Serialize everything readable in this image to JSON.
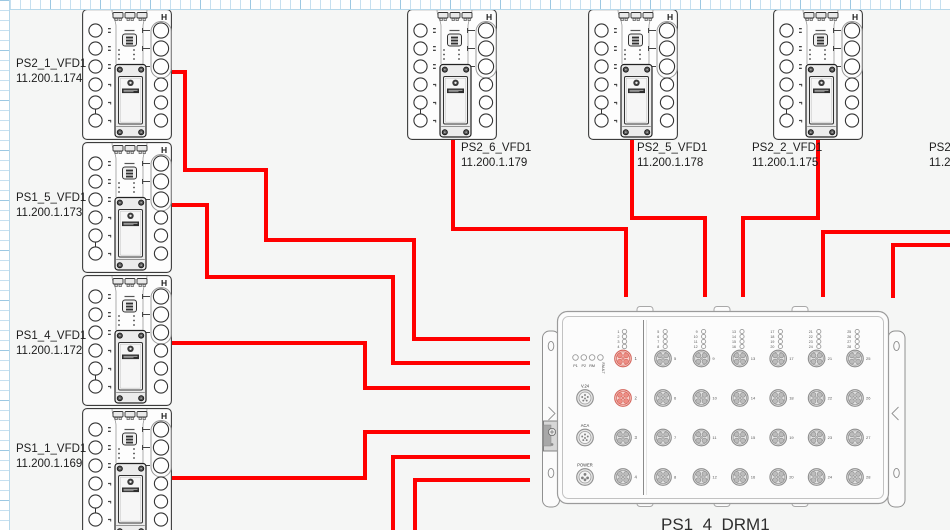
{
  "canvas": {
    "page_color": "#f5f6f5",
    "ruler_tick_color": "#c6e0f0",
    "wire_color": "#ff0000"
  },
  "devices": [
    {
      "name": "PS2_1_VFD1",
      "ip": "11.200.1.174"
    },
    {
      "name": "PS1_5_VFD1",
      "ip": "11.200.1.173"
    },
    {
      "name": "PS1_4_VFD1",
      "ip": "11.200.1.172"
    },
    {
      "name": "PS1_1_VFD1",
      "ip": "11.200.1.169"
    },
    {
      "name": "PS2_6_VFD1",
      "ip": "11.200.1.179"
    },
    {
      "name": "PS2_5_VFD1",
      "ip": "11.200.1.178"
    },
    {
      "name": "PS2_2_VFD1",
      "ip": "11.200.1.175"
    },
    {
      "name": "PS2_",
      "ip": "11.2"
    }
  ],
  "drm": {
    "title": "PS1_4_DRM1",
    "status_leds": [
      "P1",
      "P2",
      "RM",
      "FAULT"
    ],
    "left_connector_labels": [
      "V.24",
      "ACA",
      "POWER"
    ],
    "left_ports": [
      {
        "n": 1,
        "state": "red"
      },
      {
        "n": 2,
        "state": "red"
      },
      {
        "n": 3,
        "state": "gray"
      },
      {
        "n": 4,
        "state": "gray"
      }
    ],
    "right_port_columns": [
      [
        5,
        6,
        7,
        8
      ],
      [
        9,
        10,
        11,
        12
      ],
      [
        13,
        14,
        15,
        16
      ],
      [
        17,
        18,
        19,
        20
      ],
      [
        21,
        22,
        23,
        24
      ],
      [
        25,
        26,
        27,
        28
      ]
    ]
  },
  "connections": [
    {
      "name": "PS2_1_VFD1",
      "points": [
        [
          172,
          72
        ],
        [
          185,
          72
        ],
        [
          185,
          170
        ],
        [
          266,
          170
        ],
        [
          266,
          240
        ],
        [
          414,
          240
        ],
        [
          414,
          339
        ],
        [
          530,
          339
        ]
      ]
    },
    {
      "name": "PS1_5_VFD1",
      "points": [
        [
          172,
          205
        ],
        [
          207,
          205
        ],
        [
          207,
          277
        ],
        [
          393,
          277
        ],
        [
          393,
          363
        ],
        [
          530,
          363
        ]
      ]
    },
    {
      "name": "PS1_4_VFD1",
      "points": [
        [
          172,
          343
        ],
        [
          365,
          343
        ],
        [
          365,
          388
        ],
        [
          530,
          388
        ]
      ]
    },
    {
      "name": "PS1_1_VFD1",
      "points": [
        [
          172,
          478
        ],
        [
          365,
          478
        ],
        [
          365,
          432
        ],
        [
          530,
          432
        ]
      ]
    },
    {
      "name": "PS2_6_VFD1",
      "points": [
        [
          453,
          140
        ],
        [
          453,
          229
        ],
        [
          626,
          229
        ],
        [
          626,
          297
        ]
      ]
    },
    {
      "name": "PS2_5_VFD1",
      "points": [
        [
          632,
          140
        ],
        [
          632,
          218
        ],
        [
          705,
          218
        ],
        [
          705,
          297
        ]
      ]
    },
    {
      "name": "PS2_2_VFD1",
      "points": [
        [
          818,
          140
        ],
        [
          818,
          218
        ],
        [
          743,
          218
        ],
        [
          743,
          297
        ]
      ]
    },
    {
      "name": "offscreen-right-1",
      "points": [
        [
          950,
          232
        ],
        [
          823,
          232
        ],
        [
          823,
          297
        ]
      ]
    },
    {
      "name": "offscreen-right-2",
      "points": [
        [
          950,
          245
        ],
        [
          893,
          245
        ],
        [
          893,
          298
        ]
      ]
    },
    {
      "name": "offscreen-bottom-1",
      "points": [
        [
          393,
          530
        ],
        [
          393,
          457
        ],
        [
          530,
          457
        ]
      ]
    },
    {
      "name": "offscreen-bottom-2",
      "points": [
        [
          415,
          530
        ],
        [
          415,
          480
        ],
        [
          530,
          480
        ]
      ]
    }
  ]
}
